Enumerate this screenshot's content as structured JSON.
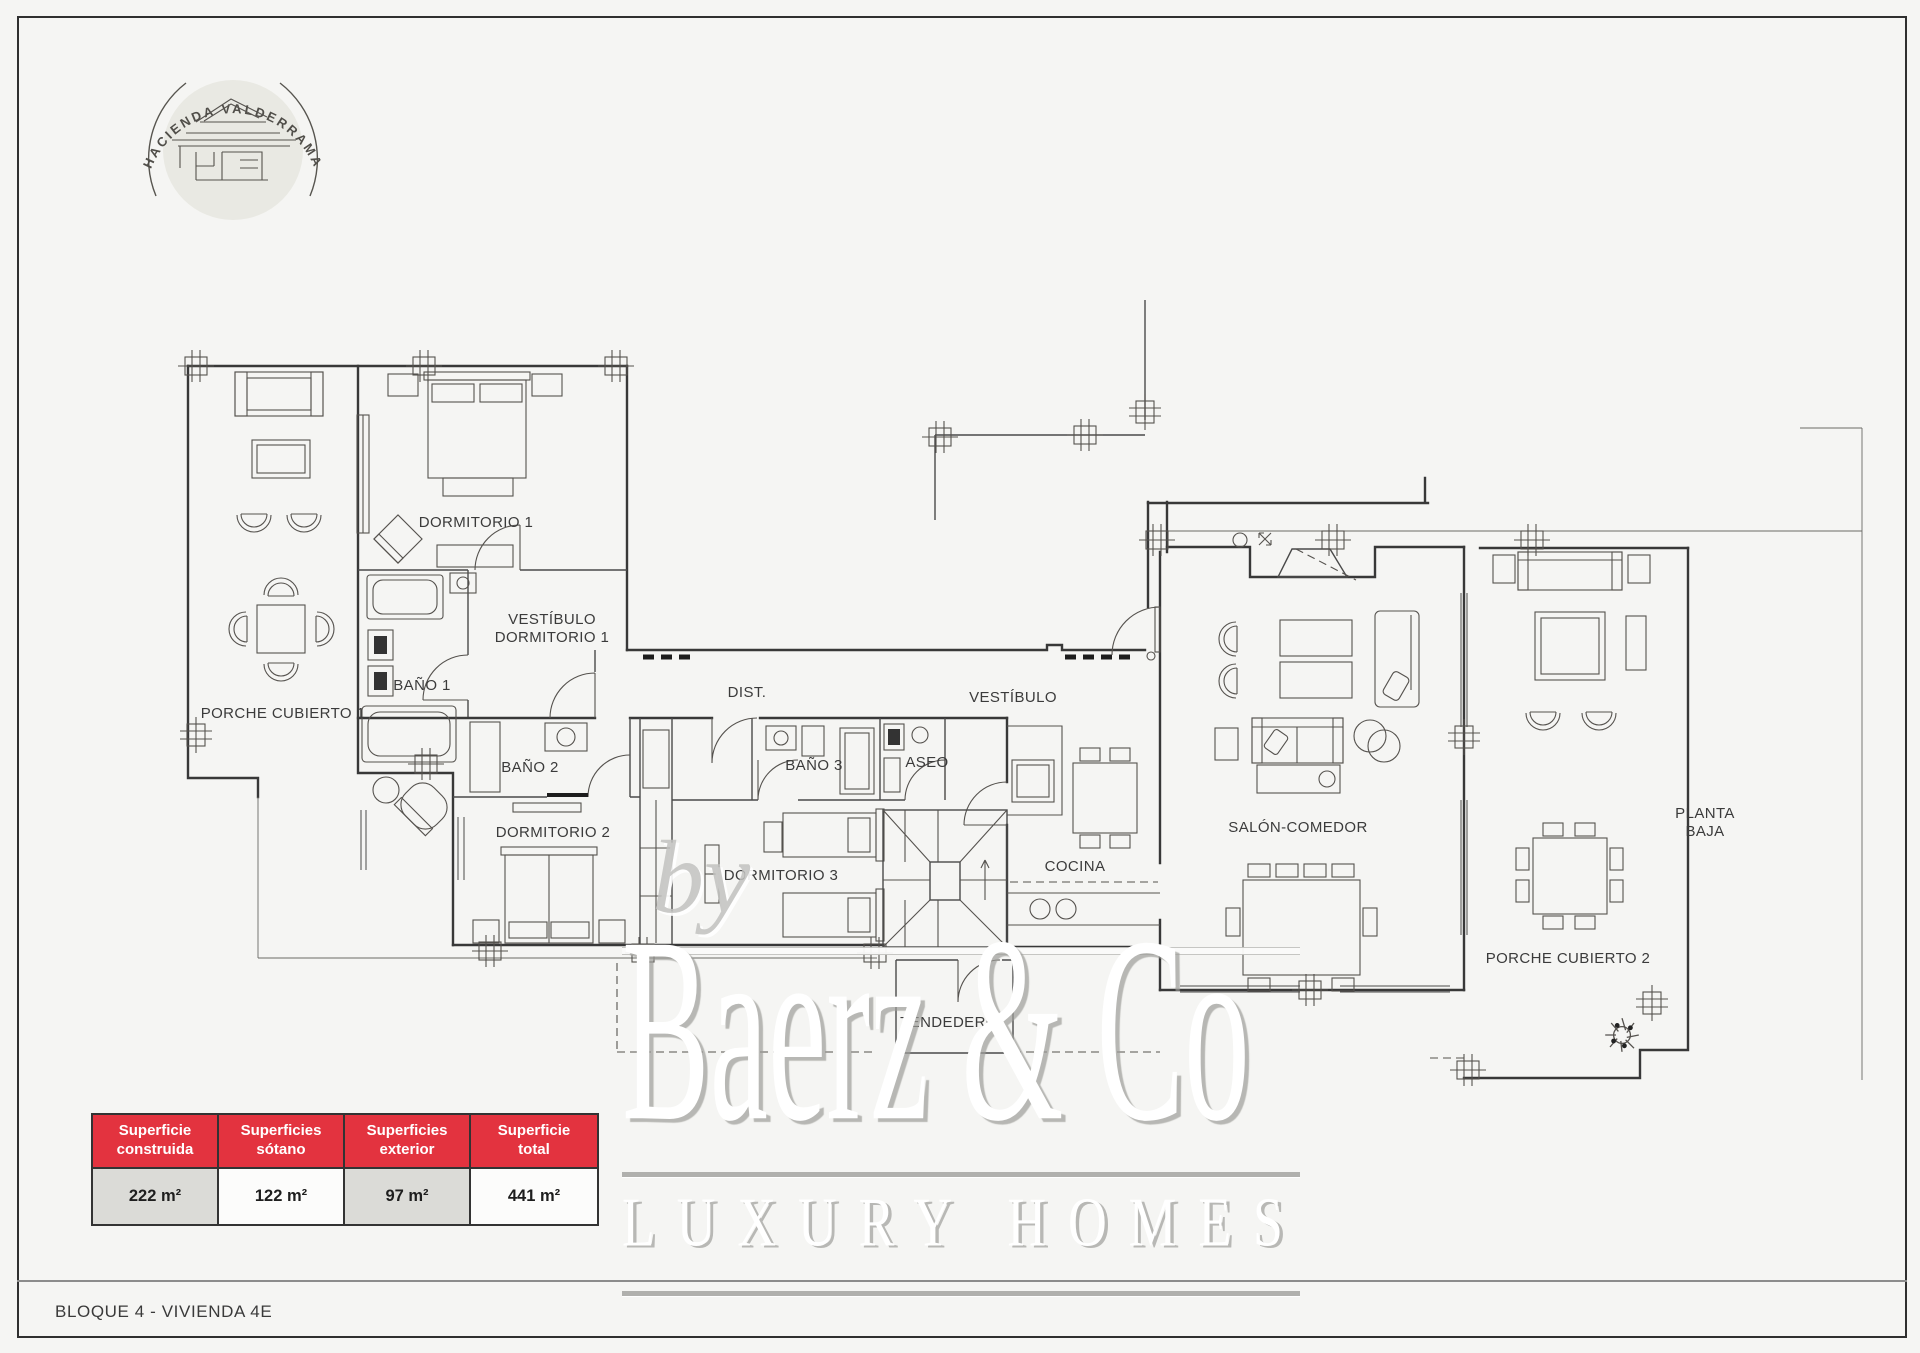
{
  "page": {
    "footer_label": "BLOQUE 4 - VIVIENDA 4E",
    "background_color": "#f5f5f3",
    "frame_color": "#2f2f2f"
  },
  "logo": {
    "arc_text": "HACIENDA VALDERRAMA"
  },
  "watermark": {
    "by_text": "by",
    "brand_text": "Baerz & Co",
    "tagline_text": "LUXURY HOMES"
  },
  "area_table": {
    "header_bg": "#e3333f",
    "columns": [
      {
        "line1": "Superficie",
        "line2": "construida",
        "value": "222 m²",
        "shaded": true
      },
      {
        "line1": "Superficies",
        "line2": "sótano",
        "value": "122 m²",
        "shaded": false
      },
      {
        "line1": "Superficies",
        "line2": "exterior",
        "value": "97 m²",
        "shaded": true
      },
      {
        "line1": "Superficie",
        "line2": "total",
        "value": "441 m²",
        "shaded": false
      }
    ]
  },
  "plan": {
    "labels": {
      "porche1": "PORCHE CUBIERTO 1",
      "dormitorio1": "DORMITORIO 1",
      "vestibulo_d1_l1": "VESTÍBULO",
      "vestibulo_d1_l2": "DORMITORIO 1",
      "bano1": "BAÑO 1",
      "bano2": "BAÑO 2",
      "dormitorio2": "DORMITORIO 2",
      "dist": "DIST.",
      "dormitorio3": "DORMITORIO 3",
      "bano3": "BAÑO 3",
      "aseo": "ASEO",
      "vestibulo": "VESTÍBULO",
      "cocina": "COCINA",
      "salon": "SALÓN-COMEDOR",
      "tendedero": "TENDEDERO",
      "porche2": "PORCHE CUBIERTO 2",
      "planta_l1": "PLANTA",
      "planta_l2": "BAJA"
    }
  }
}
